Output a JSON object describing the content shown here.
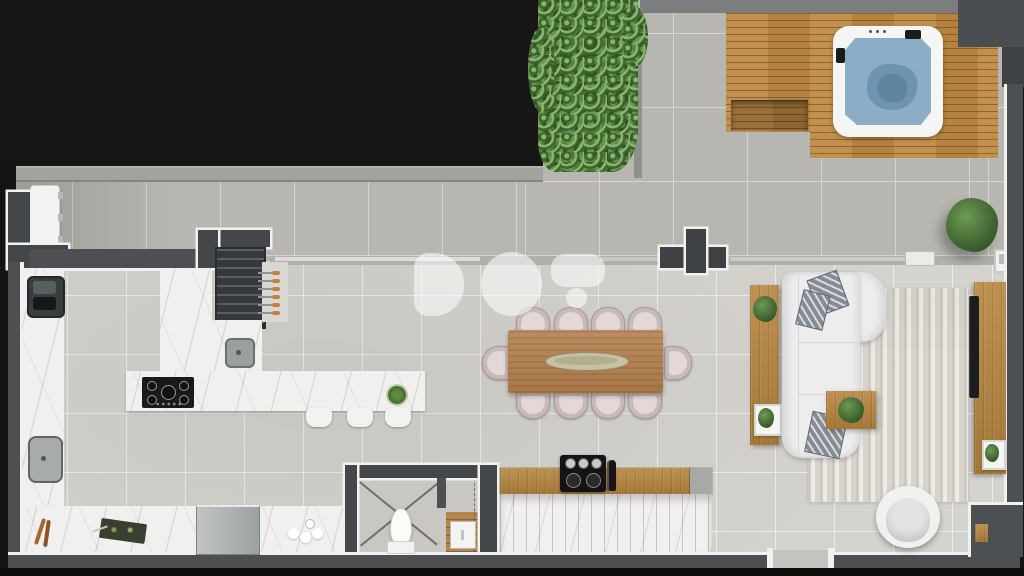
{
  "watermark": {
    "text": "DO"
  },
  "floor_plan": {
    "type": "top-down 3d rendered penthouse floor plan",
    "rooms": [
      {
        "id": "terrace",
        "items": [
          "hedge-planter",
          "wood-deck",
          "deck-bench",
          "hot-tub",
          "outdoor-bench",
          "potted-tree",
          "ac-unit",
          "parapet-wall"
        ]
      },
      {
        "id": "kitchen",
        "items": [
          "l-shaped-marble-counter",
          "double-sink",
          "prep-sink",
          "grill-sink",
          "barbecue-grill",
          "skewers",
          "gas-cooktop",
          "island-counter",
          "bar-stools",
          "refrigerator",
          "cutting-board",
          "wood-utensils",
          "dishes",
          "island-plant"
        ],
        "bar_stool_count": 3
      },
      {
        "id": "dining",
        "items": [
          "dining-table",
          "centerpiece-tray",
          "dining-chairs"
        ],
        "chair_count": 10
      },
      {
        "id": "living",
        "items": [
          "sectional-sofa",
          "throw-pillows",
          "area-rug",
          "console-table",
          "coffee-table",
          "tv-sideboard",
          "tv",
          "swivel-armchair",
          "potted-plants"
        ],
        "pillow_count": 3
      },
      {
        "id": "bar",
        "items": [
          "bar-counter",
          "espresso-machine",
          "wine-bottle",
          "marble-panel-front"
        ]
      },
      {
        "id": "wc-stairs",
        "items": [
          "toilet",
          "stair-slope-lines",
          "stair-cabinet",
          "wood-landing"
        ]
      }
    ],
    "structure": [
      "glass-sliding-door-track",
      "cross-column",
      "door-opening-bottom-wall",
      "stepped-corner-wall"
    ]
  },
  "colors": {
    "wall": "#4c5052",
    "lining": "#f1f1ef",
    "floor": "#d5d3cd",
    "terrace": "#b7b6b1",
    "deck": "#bf8b46",
    "marble": "#f1f0ee",
    "wood": "#b5853f",
    "hedge": "#4f7a3c",
    "water": "#8cadc6",
    "sofa": "#ededee",
    "rug": "#dedcd5",
    "chair": "#c9bab9"
  }
}
